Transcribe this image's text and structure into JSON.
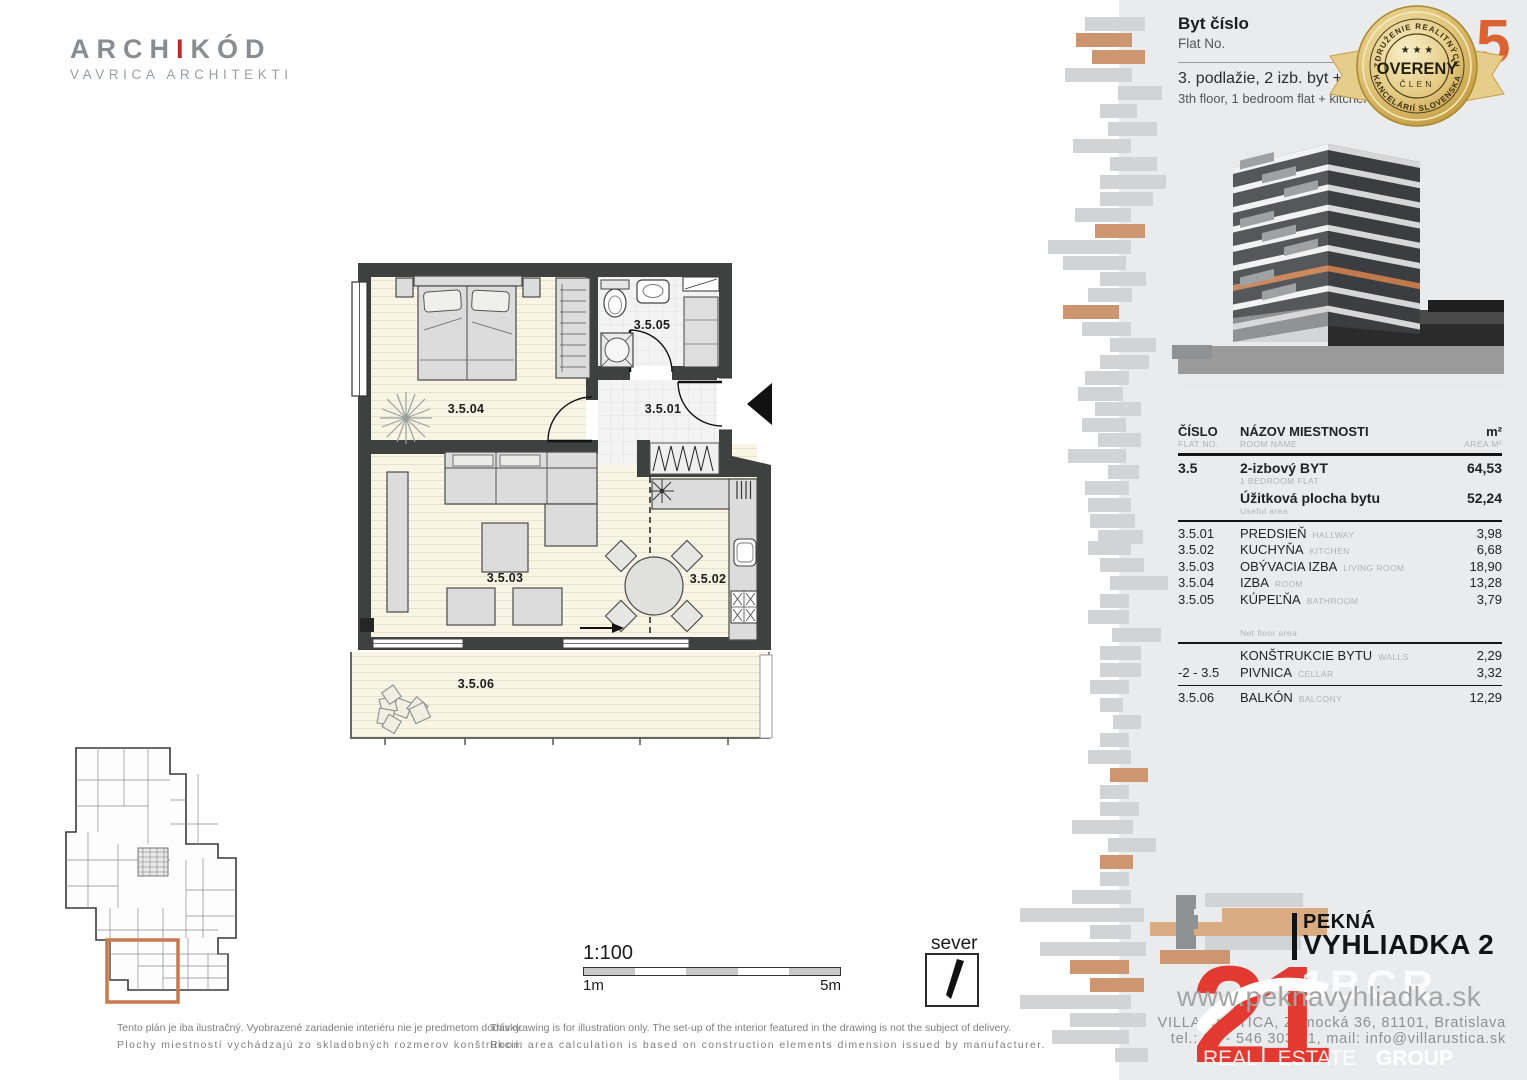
{
  "architect_logo": {
    "part1": "ARCH",
    "accent": "I",
    "part2": "KÓD",
    "subtitle": "VAVRICA ARCHITEKTI"
  },
  "header": {
    "flat_label_sk": "Byt číslo",
    "flat_label_en": "Flat No.",
    "flat_number": "5",
    "floor_line_sk": "3. podlažie, 2 izb. byt + KK",
    "floor_line_en": "3th floor, 1 bedroom flat + kitchen"
  },
  "badge": {
    "arc_top": "ZDRUŽENIE REALITNÝCH",
    "arc_bottom": "KANCELÁRIÍ SLOVENSKA",
    "stars": "★ ★ ★",
    "center": "OVERENÝ",
    "member": "ČLEN"
  },
  "table": {
    "headers": {
      "col1_sk": "ČÍSLO",
      "col1_en": "FLAT NO.",
      "col2_sk": "NÁZOV MIESTNOSTI",
      "col2_en": "ROOM NAME",
      "col3_sk": "m²",
      "col3_en": "AREA M²"
    },
    "summary": [
      {
        "no": "3.5",
        "name_sk": "2-izbový BYT",
        "name_en": "1 BEDROOM FLAT",
        "area": "64,53"
      },
      {
        "no": "",
        "name_sk": "Úžitková plocha bytu",
        "name_en": "Useful area",
        "area": "52,24"
      }
    ],
    "rooms": [
      {
        "no": "3.5.01",
        "name_sk": "PREDSIEŇ",
        "name_en": "HALLWAY",
        "area": "3,98"
      },
      {
        "no": "3.5.02",
        "name_sk": "KUCHYŇA",
        "name_en": "KITCHEN",
        "area": "6,68"
      },
      {
        "no": "3.5.03",
        "name_sk": "OBÝVACIA IZBA",
        "name_en": "LIVING ROOM",
        "area": "18,90"
      },
      {
        "no": "3.5.04",
        "name_sk": "IZBA",
        "name_en": "ROOM",
        "area": "13,28"
      },
      {
        "no": "3.5.05",
        "name_sk": "KÚPEĽŇA",
        "name_en": "BATHROOM",
        "area": "3,79"
      }
    ],
    "net_floor_label": "Net floor area",
    "extras": [
      {
        "no": "",
        "name_sk": "KONŠTRUKCIE BYTU",
        "name_en": "WALLS",
        "area": "2,29"
      },
      {
        "no": "-2 - 3.5",
        "name_sk": "PIVNICA",
        "name_en": "CELLAR",
        "area": "3,32"
      },
      {
        "no": "3.5.06",
        "name_sk": "BALKÓN",
        "name_en": "BALCONY",
        "area": "12,29"
      }
    ]
  },
  "plan": {
    "labels": [
      {
        "id": "3.5.01"
      },
      {
        "id": "3.5.02"
      },
      {
        "id": "3.5.03"
      },
      {
        "id": "3.5.04"
      },
      {
        "id": "3.5.05"
      },
      {
        "id": "3.5.06"
      }
    ],
    "scale": "1:100",
    "scale_start": "1m",
    "scale_end": "5m",
    "north": "sever"
  },
  "disclaimer": {
    "sk1": "Tento plán je iba ilustračný. Vyobrazené zariadenie interiéru nie je predmetom dodávky.",
    "sk2": "Plochy miestností vychádzajú zo skladobných rozmerov konštrukcií.",
    "en1": "This drawing is for illustration only. The set-up of the interior featured in the drawing is not the subject of delivery.",
    "en2": "Room area calculation is based on construction elements dimension issued by manufacturer."
  },
  "footer": {
    "project_line1": "PEKNÁ",
    "project_line2": "VYHLIADKA 2",
    "website": "www.peknavyhliadka.sk",
    "watermark": "1BCR",
    "address": "VILLA RUSTICA, Zámocká 36, 81101, Bratislava",
    "contact": "tel.: 02 - 546 303 61, mail: info@villarustica.sk",
    "real": "REAL",
    "estate": "ESTATE",
    "group": "GROUP",
    "logo21": "21"
  },
  "colors": {
    "accent_orange": "#cd9570",
    "bar_gray": "#d2d3d4",
    "panel_gray": "#eaebec",
    "wall": "#3f4040",
    "brand_red": "#e23a31",
    "badge_gold": "#d9b967",
    "highlight_orange": "#c8794e"
  }
}
